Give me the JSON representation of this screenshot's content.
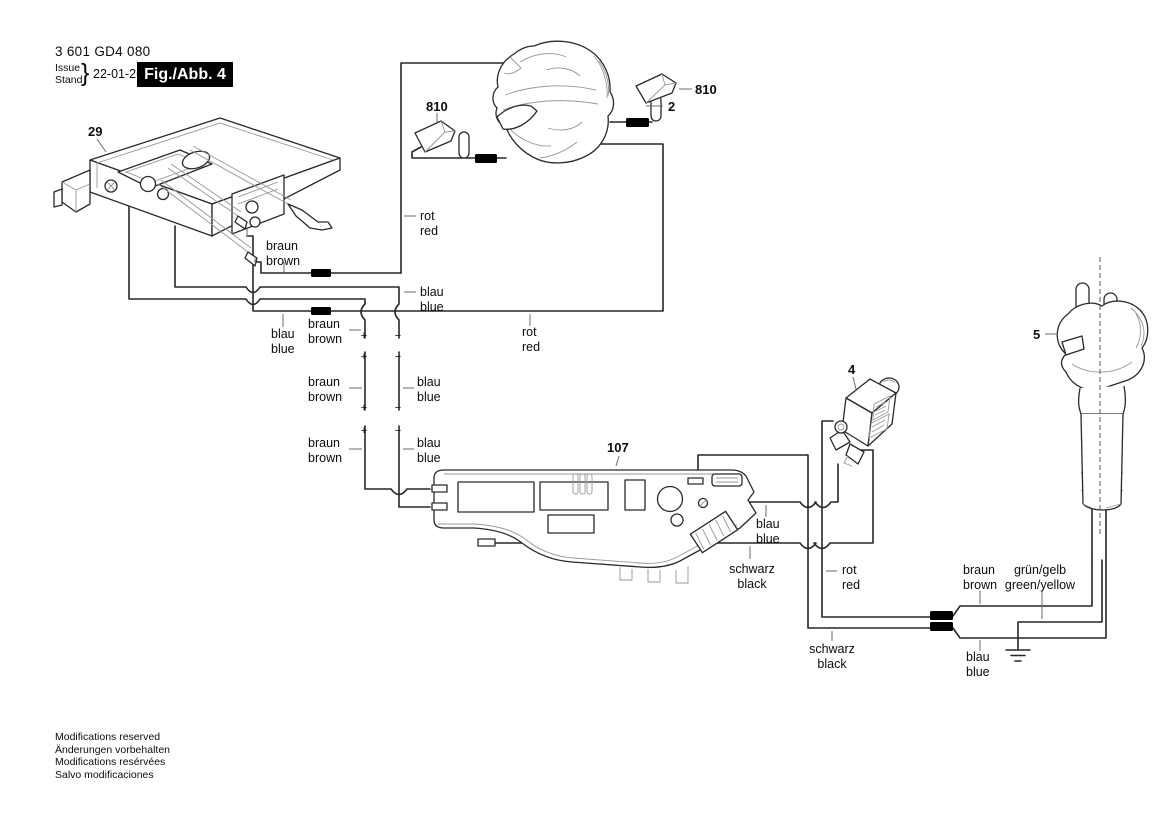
{
  "header": {
    "part_number": "3 601 GD4 080",
    "issue_label": "Issue",
    "stand_label": "Stand",
    "brace": "}",
    "date": "22-01-26",
    "fig_label": "Fig./Abb. 4"
  },
  "footer": {
    "line1": "Modifications reserved",
    "line2": "Änderungen vorbehalten",
    "line3": "Modifications resérvées",
    "line4": "Salvo modificaciones"
  },
  "part_labels": {
    "switch": "29",
    "brush_left": "810",
    "brush_right": "810",
    "field_coil": "2",
    "suppressor": "4",
    "plug": "5",
    "module": "107"
  },
  "wire_labels": {
    "braun_switch": {
      "de": "braun",
      "en": "brown"
    },
    "rot_field_left": {
      "de": "rot",
      "en": "red"
    },
    "blau_corner": {
      "de": "blau",
      "en": "blue"
    },
    "blau_long_left": {
      "de": "blau",
      "en": "blue"
    },
    "braun_long_left": {
      "de": "braun",
      "en": "brown"
    },
    "braun_plug1": {
      "de": "braun",
      "en": "brown"
    },
    "blau_plug1": {
      "de": "blau",
      "en": "blue"
    },
    "braun_plug2": {
      "de": "braun",
      "en": "brown"
    },
    "blau_plug2": {
      "de": "blau",
      "en": "blue"
    },
    "rot_long": {
      "de": "rot",
      "en": "red"
    },
    "blau_module": {
      "de": "blau",
      "en": "blue"
    },
    "schwarz_module": {
      "de": "schwarz",
      "en": "black"
    },
    "rot_suppressor": {
      "de": "rot",
      "en": "red"
    },
    "schwarz_cord": {
      "de": "schwarz",
      "en": "black"
    },
    "braun_cord": {
      "de": "braun",
      "en": "brown"
    },
    "gruen_gelb_cord": {
      "de": "grün/gelb",
      "en": "green/yellow"
    },
    "blau_cord": {
      "de": "blau",
      "en": "blue"
    }
  },
  "polarity": {
    "plus": "+",
    "minus": "−"
  },
  "colors": {
    "line": "#26262b",
    "label": "#0c0c0c",
    "sleeve": "#000000",
    "background": "#ffffff"
  }
}
